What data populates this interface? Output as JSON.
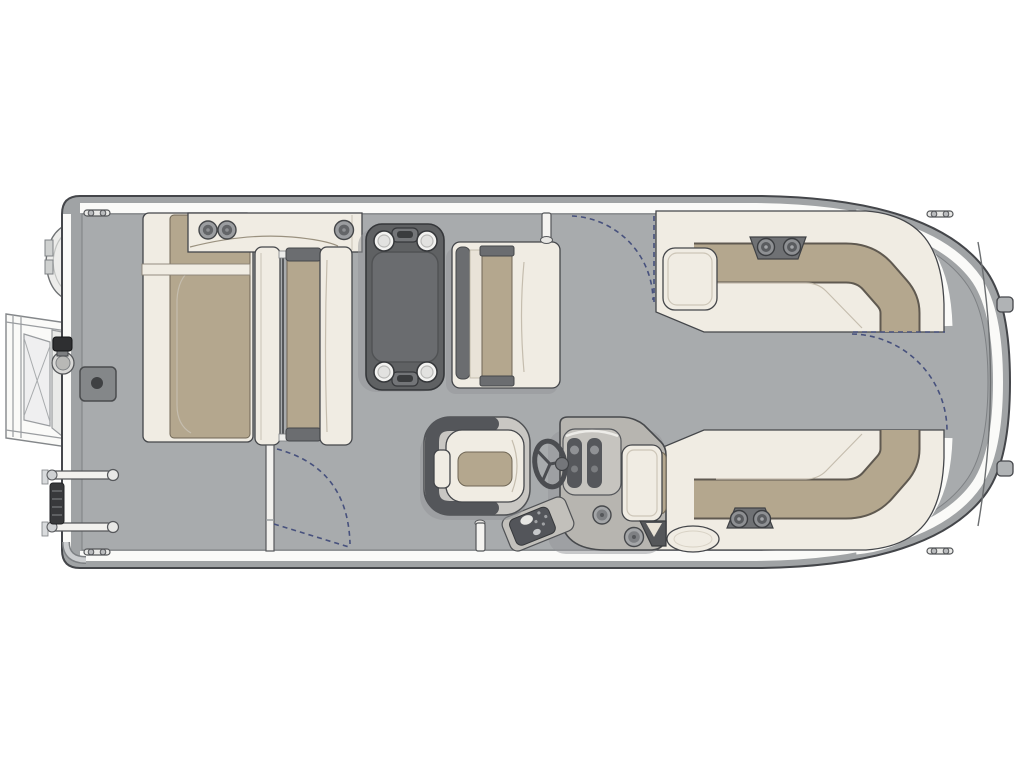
{
  "scene": {
    "type": "pontoon-boat-floorplan-top-view",
    "orientation": "bow-right-stern-left",
    "background": "#ffffff"
  },
  "colors": {
    "bg": "#ffffff",
    "band": "#a0a3a5",
    "deck": "#a8abad",
    "rail": "#fafaf8",
    "cream": "#f0ece3",
    "tan": "#b4a78e",
    "dark": "#5f6163",
    "console": "#b7b5b0",
    "navy": "#47517d",
    "outline": "#44464a"
  },
  "components": {
    "hull": {
      "name": "pontoon deck with rounded bow nose cone",
      "cleats": 4,
      "nose_tabs": 2,
      "rub_rail": "white band along port, starboard and bow edges"
    },
    "stern_left": {
      "boarding_ramp": "open frame ramp with cross bracing, swung out to port stern",
      "motor_pod": "rounded pod on stern edge",
      "fuel_filler": "capped cylinder fitting",
      "ski_tow_base": "gray square pad with center socket",
      "reboarding_ladder": "two rails with folded dark step section"
    },
    "port_bow_group": {
      "top_bench": {
        "cupholders": 3
      },
      "chaise_lounge": {
        "cushion": "tan",
        "base": "cream"
      },
      "back_to_back_bench": {
        "cushion": "tan",
        "end_caps": "dark gray"
      }
    },
    "table": {
      "shape": "rounded rectangle",
      "color": "dark gray",
      "cupholders": 4,
      "handles": 2
    },
    "dinette_bench": {
      "facing": "table",
      "cushion": "tan",
      "backrest": "cream"
    },
    "starboard_bow_lounge": {
      "shape": "L wrap-around",
      "cupholders": 2,
      "armrest_box": true
    },
    "starboard_stern_lounge": {
      "shape": "L wrap-around",
      "cupholders": 2,
      "end_pillow": "oval"
    },
    "helm": {
      "captain_chair": {
        "shell": "dark gray",
        "cushion": "tan"
      },
      "console": {
        "gauge_pods": 2,
        "steering_wheel": true,
        "switch_panel": true,
        "speakers": 2
      },
      "cooler_seat": true
    },
    "gates": {
      "port_side_gate": "dashed swing arc near top fence",
      "bow_gate": "dashed swing arc at bow walk-through",
      "starboard_side_gate": "dashed swing arc with open door partition at bottom left"
    }
  }
}
